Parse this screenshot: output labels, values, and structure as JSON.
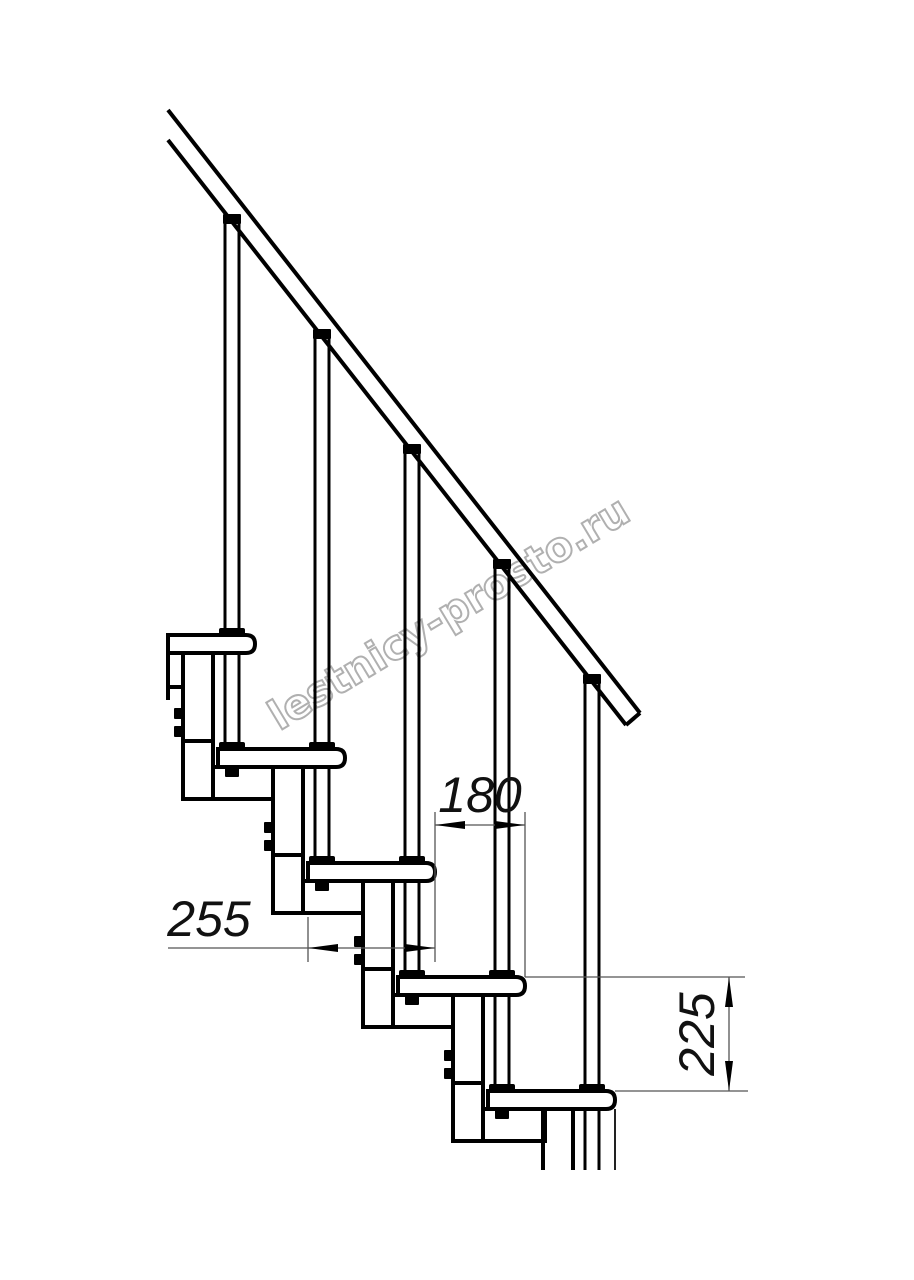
{
  "drawing": {
    "type": "staircase-side-elevation",
    "steps_visible": 5,
    "balusters_visible": 5,
    "background_color": "#ffffff",
    "structure_line_color": "#000000",
    "dimension_line_color": "#555555",
    "dimension_text_color": "#111111"
  },
  "dimensions": {
    "step_run": "180",
    "tread_depth": "255",
    "step_rise": "225"
  },
  "watermark": {
    "text": "lestnicy-prosto.ru",
    "color": "#b0b0b0"
  }
}
